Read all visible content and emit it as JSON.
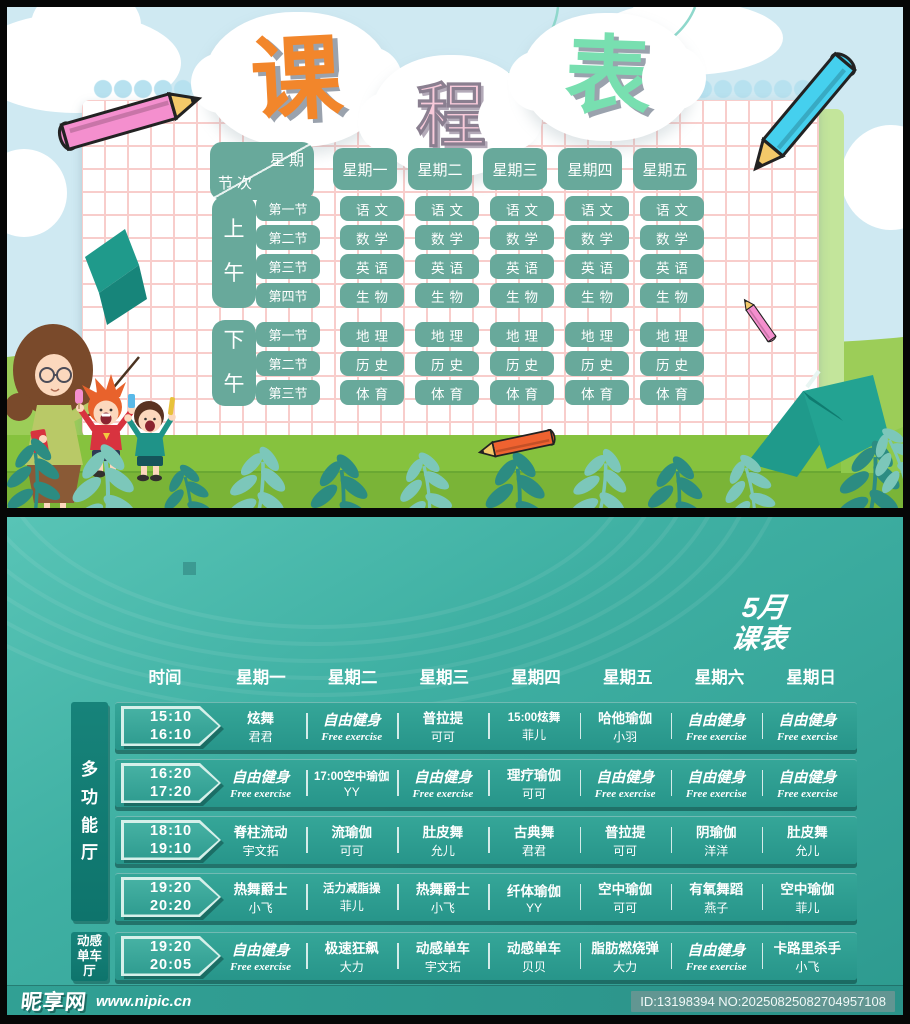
{
  "palette": {
    "teal_box": "#68a99b",
    "sky": "#cfe9f2",
    "grid_pink": "#f8cdcb",
    "grass": "#85c13d",
    "poster2_teal": "#2f9d92",
    "band_teal": "#2a9a8f",
    "sidebar_teal": "#117d75",
    "title_orange": "#f2862b",
    "title_pink": "#f7cada",
    "title_mint": "#78dfb0"
  },
  "top": {
    "title": {
      "c1": "课",
      "c2": "程",
      "c3": "表"
    },
    "corner": {
      "top": "星期",
      "bottom": "节次"
    },
    "days": [
      "星期一",
      "星期二",
      "星期三",
      "星期四",
      "星期五"
    ],
    "sections": [
      {
        "label": "上午",
        "rows": [
          {
            "period": "第一节",
            "subjects": [
              "语文",
              "语文",
              "语文",
              "语文",
              "语文"
            ]
          },
          {
            "period": "第二节",
            "subjects": [
              "数学",
              "数学",
              "数学",
              "数学",
              "数学"
            ]
          },
          {
            "period": "第三节",
            "subjects": [
              "英语",
              "英语",
              "英语",
              "英语",
              "英语"
            ]
          },
          {
            "period": "第四节",
            "subjects": [
              "生物",
              "生物",
              "生物",
              "生物",
              "生物"
            ]
          }
        ]
      },
      {
        "label": "下午",
        "rows": [
          {
            "period": "第一节",
            "subjects": [
              "地理",
              "地理",
              "地理",
              "地理",
              "地理"
            ]
          },
          {
            "period": "第二节",
            "subjects": [
              "历史",
              "历史",
              "历史",
              "历史",
              "历史"
            ]
          },
          {
            "period": "第三节",
            "subjects": [
              "体育",
              "体育",
              "体育",
              "体育",
              "体育"
            ]
          }
        ]
      }
    ]
  },
  "bottom": {
    "month_line1": "5月",
    "month_line2": "课表",
    "time_header": "时间",
    "days": [
      "星期一",
      "星期二",
      "星期三",
      "星期四",
      "星期五",
      "星期六",
      "星期日"
    ],
    "venues": [
      {
        "name": "多功能厅",
        "lines": [
          "多",
          "功",
          "能",
          "厅"
        ],
        "rows": [
          {
            "t1": "15:10",
            "t2": "16:10",
            "cells": [
              [
                "炫舞",
                "君君"
              ],
              [
                "自由健身",
                "Free exercise"
              ],
              [
                "普拉提",
                "可可"
              ],
              [
                "15:00炫舞",
                "菲儿"
              ],
              [
                "哈他瑜伽",
                "小羽"
              ],
              [
                "自由健身",
                "Free exercise"
              ],
              [
                "自由健身",
                "Free exercise"
              ]
            ]
          },
          {
            "t1": "16:20",
            "t2": "17:20",
            "cells": [
              [
                "自由健身",
                "Free exercise"
              ],
              [
                "17:00空中瑜伽",
                "YY"
              ],
              [
                "自由健身",
                "Free exercise"
              ],
              [
                "理疗瑜伽",
                "可可"
              ],
              [
                "自由健身",
                "Free exercise"
              ],
              [
                "自由健身",
                "Free exercise"
              ],
              [
                "自由健身",
                "Free exercise"
              ]
            ]
          },
          {
            "t1": "18:10",
            "t2": "19:10",
            "cells": [
              [
                "脊柱流动",
                "宇文拓"
              ],
              [
                "流瑜伽",
                "可可"
              ],
              [
                "肚皮舞",
                "允儿"
              ],
              [
                "古典舞",
                "君君"
              ],
              [
                "普拉提",
                "可可"
              ],
              [
                "阴瑜伽",
                "洋洋"
              ],
              [
                "肚皮舞",
                "允儿"
              ]
            ]
          },
          {
            "t1": "19:20",
            "t2": "20:20",
            "cells": [
              [
                "热舞爵士",
                "小飞"
              ],
              [
                "活力减脂操",
                "菲儿"
              ],
              [
                "热舞爵士",
                "小飞"
              ],
              [
                "纤体瑜伽",
                "YY"
              ],
              [
                "空中瑜伽",
                "可可"
              ],
              [
                "有氧舞蹈",
                "燕子"
              ],
              [
                "空中瑜伽",
                "菲儿"
              ]
            ]
          }
        ]
      },
      {
        "name": "动感单车厅",
        "lines": [
          "动感",
          "单车",
          "厅"
        ],
        "rows": [
          {
            "t1": "19:20",
            "t2": "20:05",
            "cells": [
              [
                "自由健身",
                "Free exercise"
              ],
              [
                "极速狂飙",
                "大力"
              ],
              [
                "动感单车",
                "宇文拓"
              ],
              [
                "动感单车",
                "贝贝"
              ],
              [
                "脂肪燃烧弹",
                "大力"
              ],
              [
                "自由健身",
                "Free exercise"
              ],
              [
                "卡路里杀手",
                "小飞"
              ]
            ]
          }
        ]
      }
    ]
  },
  "footer": {
    "site": "昵享网",
    "url": "www.nipic.cn",
    "id_no": "ID:13198394 NO:20250825082704957108"
  },
  "decorations": [
    "pink-pencil-icon",
    "blue-pencil-icon",
    "small-pink-pencil-icon",
    "orange-pencil-icon",
    "teacher-with-pointer",
    "kid-red-shirt",
    "kid-teal-shirt",
    "open-book-icon",
    "folded-paper-icon",
    "clouds",
    "leaf-branches",
    "title-clouds",
    "hanging-strings",
    "grid-paper",
    "grass-hill"
  ]
}
